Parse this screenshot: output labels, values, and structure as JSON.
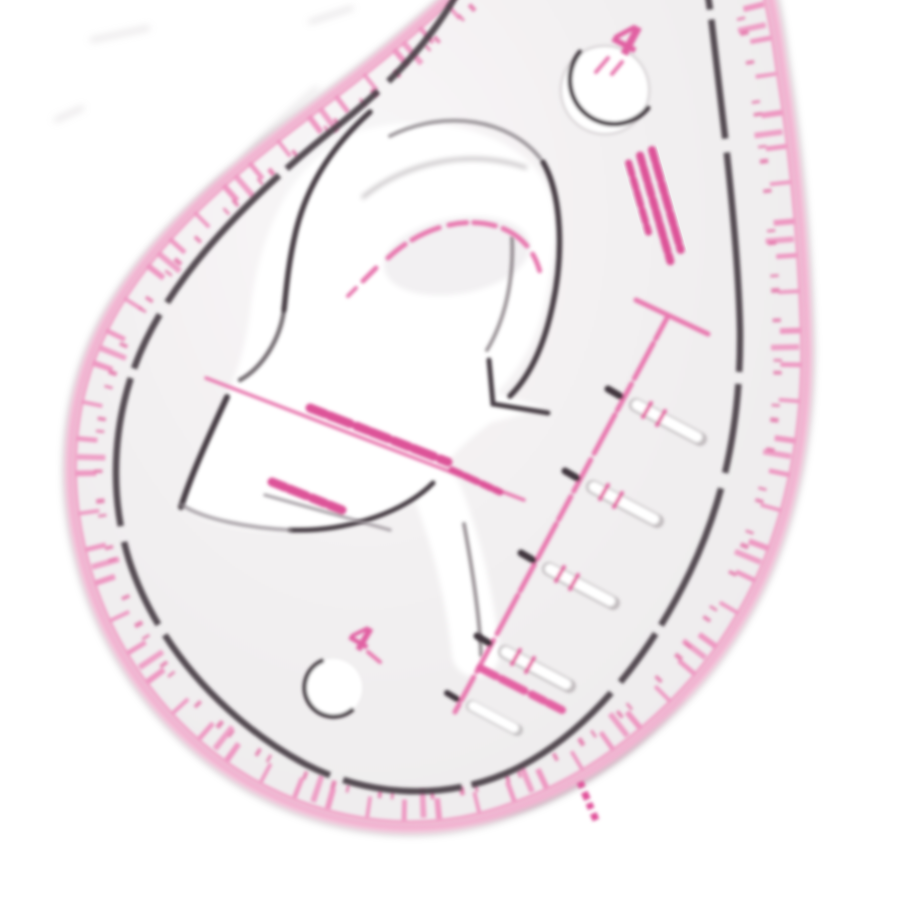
{
  "image": {
    "type": "product-photo",
    "subject": "Transparent teardrop (pear) shaped sewing French-curve ruler with pink printed scales, photographed blurry on a white background",
    "background": "white",
    "orientation": "rounded end at lower left, tip pointing off-frame at upper right"
  },
  "ruler": {
    "rim_scale": {
      "description": "pink tick marks with tiny illegible pink numerals all around the rim between the pink outer edge and the dark inner outline",
      "tick_count_visible": "approx 40"
    },
    "inner_outline": "soft dark broken line following the teardrop shape inside the rim",
    "center_cutout": "large stylized numeral-like white cutout with partial dark edges (arc, hook and bowl strokes)",
    "buttonhole_scale": {
      "description": "diagonal pink center line with a top crossbar, dark stops, white slot marks and small pink ticks",
      "rungs": 5
    },
    "holes": [
      {
        "id": "top-hole",
        "label": "4",
        "cx": 605,
        "cy": 90,
        "r": 44
      },
      {
        "id": "bottom-hole",
        "label": "4",
        "cx": 333,
        "cy": 688,
        "r": 29
      }
    ],
    "annotations": [
      "illegible pink text block near the right edge (3 short rows, rotated)",
      "illegible pink text line across the cutout bowl",
      "second shorter illegible pink text line with grey underline",
      "dashed pink curved guide inside the hook of the cutout"
    ]
  },
  "labels": {
    "top_hole_number": "4",
    "bottom_hole_number": "4"
  },
  "colors": {
    "background": "#ffffff",
    "body_highlight": "#f8f6f7",
    "body_mid": "#f1eff0",
    "body_edge": "#edeaec",
    "pink_edge": "#f3b5d2",
    "pink_rim_tick": "#ee96c1",
    "pink_marking": "#e878af",
    "pink_text": "#dd5298",
    "magenta_accent": "#e0519a",
    "dark_line": "#473e44",
    "grey_line": "#938b90",
    "outer_grey": "#b3abb0"
  }
}
